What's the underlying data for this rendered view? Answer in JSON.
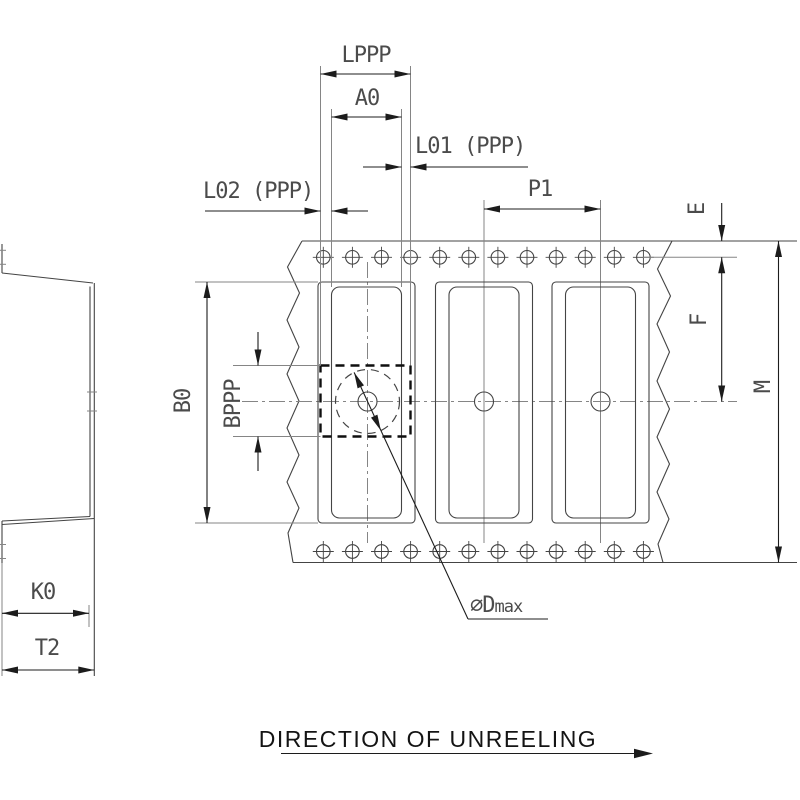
{
  "labels": {
    "lppp": "LPPP",
    "a0": "A0",
    "l01": "L01 (PPP)",
    "l02": "L02 (PPP)",
    "p1": "P1",
    "e": "E",
    "f": "F",
    "m": "M",
    "b0": "B0",
    "bppp": "BPPP",
    "k0": "K0",
    "t2": "T2",
    "dmax_prefix": "∅D",
    "dmax_suffix": "max",
    "direction": "DIRECTION OF UNREELING"
  },
  "colors": {
    "object_line": "#444444",
    "light_line": "#858585",
    "dimension_line": "#1c1c1c",
    "dashed_outline": "#0f0f0f",
    "label_text": "#4b4b4b",
    "direction_text": "#141414",
    "background": "#ffffff"
  }
}
